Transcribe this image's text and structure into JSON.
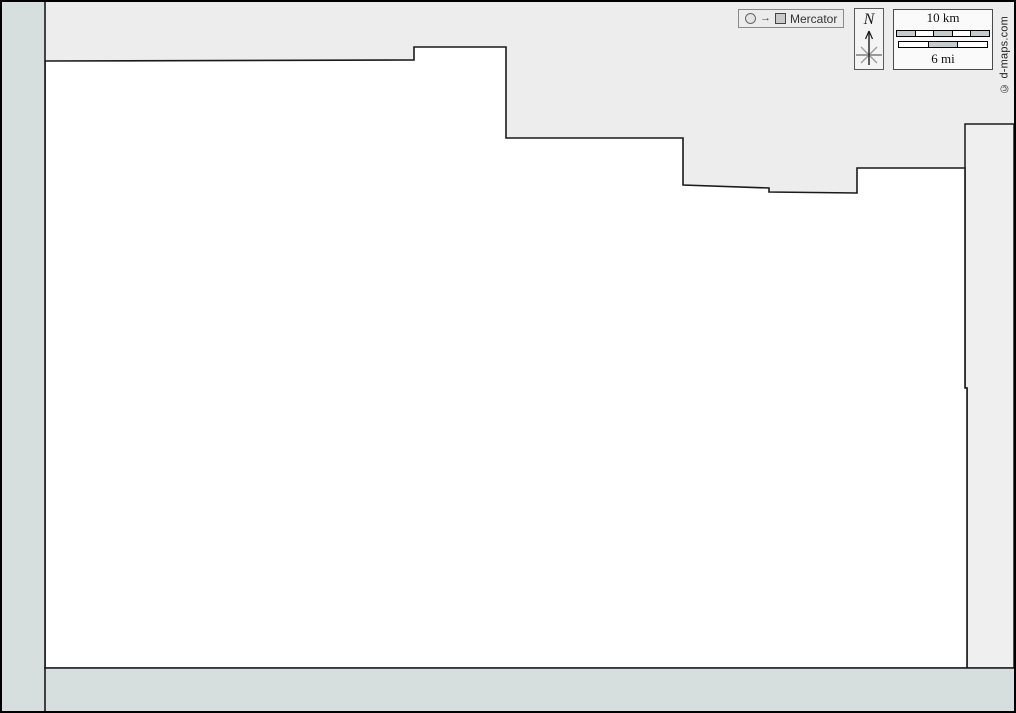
{
  "map": {
    "projection_badge": {
      "label": "Mercator"
    },
    "compass": {
      "north_label": "N"
    },
    "scale_bar": {
      "km_label": "10 km",
      "mi_label": "6 mi"
    },
    "copyright": "© d-maps.com",
    "colors": {
      "page_background": "#ededed",
      "main_region_fill": "#ffffff",
      "margin_strip_fill": "#d7dede",
      "neighbor_region_fill": "#efefef",
      "boundary_line": "#1a1a1a",
      "scale_segment_gray": "#c6cccc"
    }
  }
}
